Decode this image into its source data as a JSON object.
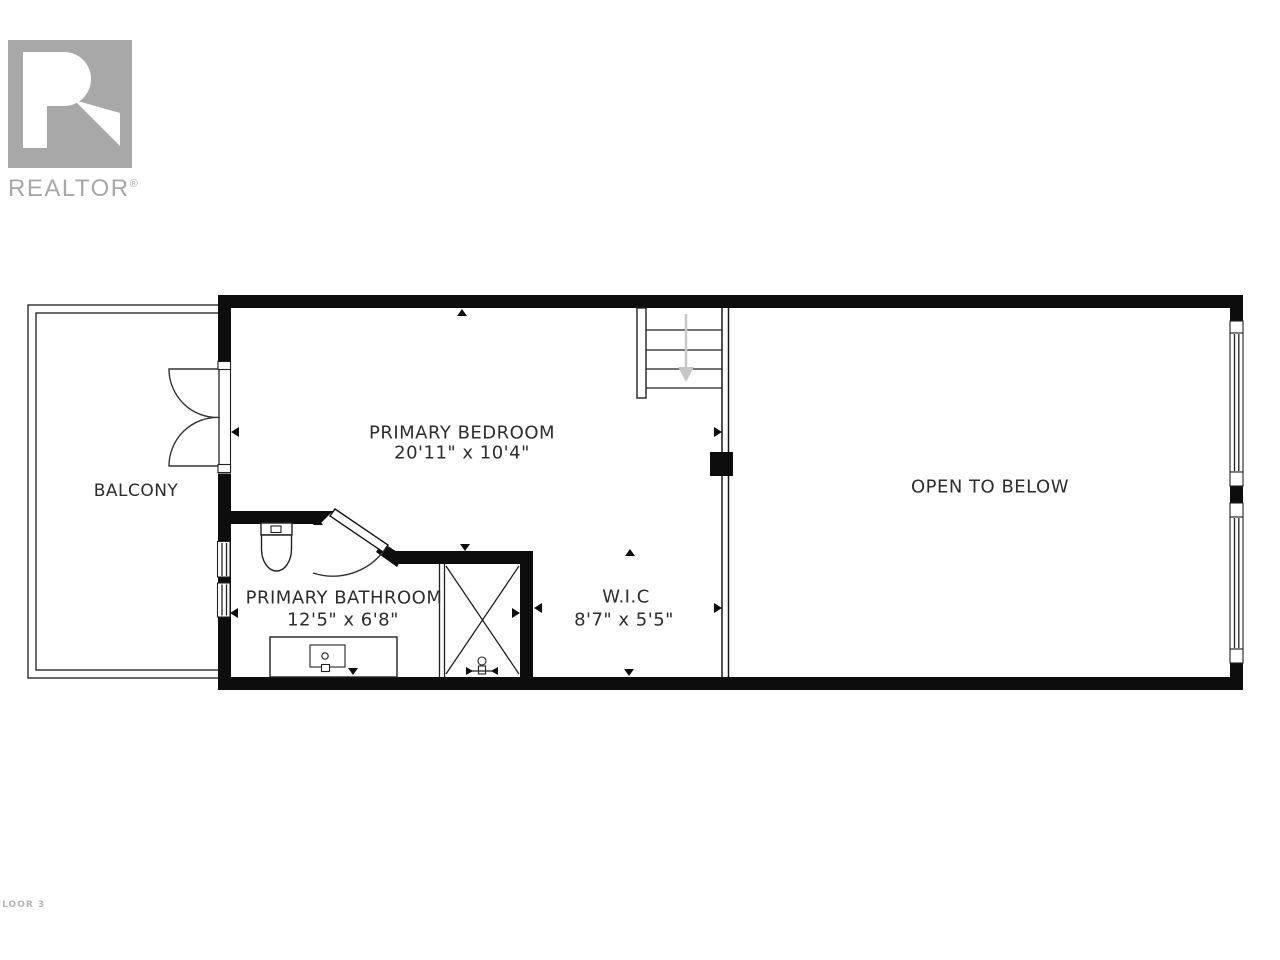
{
  "logo": {
    "text": "REALTOR",
    "mark": "®"
  },
  "floor_label": "FLOOR 3",
  "rooms": {
    "bedroom": {
      "name": "PRIMARY BEDROOM",
      "dims": "20'11\" x 10'4\""
    },
    "bathroom": {
      "name": "PRIMARY BATHROOM",
      "dims": "12'5\" x 6'8\""
    },
    "wic": {
      "name": "W.I.C",
      "dims": "8'7\" x 5'5\""
    },
    "balcony": {
      "name": "BALCONY"
    },
    "open_to_below": {
      "name": "OPEN TO BELOW"
    }
  },
  "colors": {
    "wall": "#0d0d0d",
    "logo_gray": "#a8a8a8",
    "stair_arrow": "#c6c6c6",
    "label_text": "#2d2d2d",
    "floor_label_gray": "#b5b5b5"
  }
}
